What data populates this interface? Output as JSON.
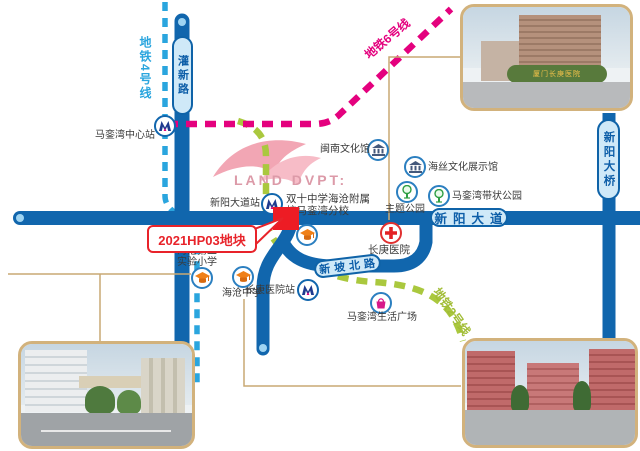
{
  "logo": {
    "text": "LAND DVPT:"
  },
  "parcel": {
    "label": "2021HP03地块"
  },
  "colors": {
    "road": "#1166ad",
    "road_fill": "#cfe9f8",
    "metro4": "#2aa5de",
    "metro6": "#e4017e",
    "metro2": "#aac83e",
    "parcel_red": "#ed1c24",
    "connector": "#c9a873",
    "photo_border": "#d2b27c"
  },
  "metro_lines": [
    {
      "name": "地铁4号线"
    },
    {
      "name": "地铁6号线"
    },
    {
      "name": "地铁2号线"
    }
  ],
  "roads": [
    {
      "name": "灌新路"
    },
    {
      "name": "新阳大道"
    },
    {
      "name": "新阳大桥"
    },
    {
      "name": "新坡北路"
    }
  ],
  "stations": [
    {
      "name": "马銮湾中心站"
    },
    {
      "name": "新阳大道站"
    },
    {
      "name": "长庚医院站"
    }
  ],
  "landmarks": {
    "minnan": {
      "name": "闽南文化馆",
      "type": "museum"
    },
    "haisi": {
      "name": "海丝文化展示馆",
      "type": "museum"
    },
    "theme_park": {
      "name": "主题公园",
      "type": "park"
    },
    "ribbon_park": {
      "name": "马銮湾带状公园",
      "type": "park"
    },
    "hospital": {
      "name": "长庚医院",
      "type": "hospital"
    },
    "plaza": {
      "name": "马銮湾生活广场",
      "type": "shopping"
    },
    "second_primary": {
      "line1": "海沧第二",
      "line2": "实验小学",
      "type": "school"
    },
    "haicang_middle": {
      "name": "海沧中学",
      "type": "school"
    },
    "shuangshi": {
      "line1": "双十中学海沧附属",
      "line2": "校马銮湾分校",
      "type": "school"
    }
  },
  "photos": {
    "hospital": {
      "sign": "厦门长庚医院"
    }
  }
}
